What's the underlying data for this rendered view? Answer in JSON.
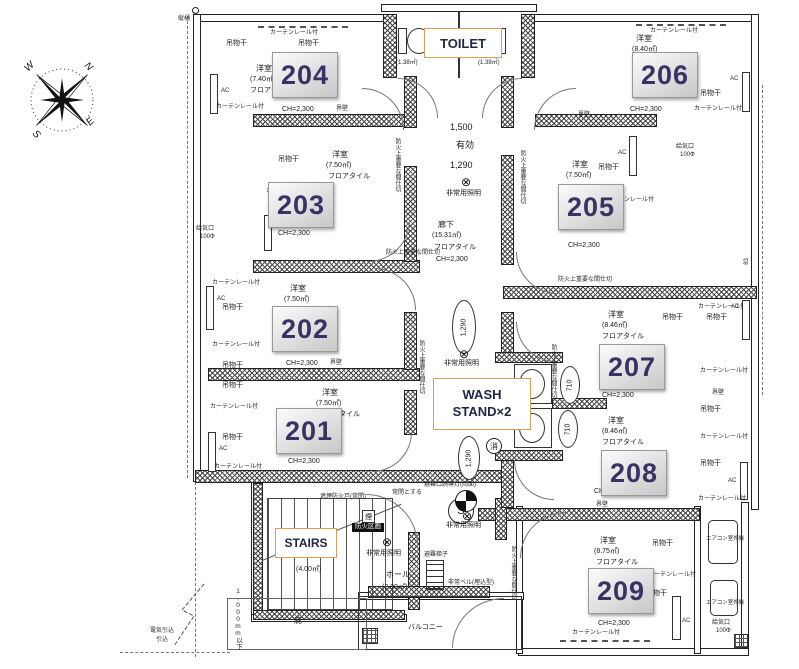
{
  "compass": {
    "n": "N",
    "e": "E",
    "s": "S",
    "w": "W"
  },
  "boxes": {
    "toilet": "TOILET",
    "wash_line1": "WASH",
    "wash_line2": "STAND×2",
    "stairs": "STAIRS"
  },
  "rooms": [
    {
      "number": "201",
      "type": "洋室",
      "area": "(7.50㎡)",
      "finish": "フロアタイル",
      "ch": "CH=2,300"
    },
    {
      "number": "202",
      "type": "洋室",
      "area": "(7.50㎡)",
      "finish": "フロアタイル",
      "ch": "CH=2,300"
    },
    {
      "number": "203",
      "type": "洋室",
      "area": "(7.50㎡)",
      "finish": "フロアタイル",
      "ch": "CH=2,300"
    },
    {
      "number": "204",
      "type": "洋室",
      "area": "(7.40㎡)",
      "finish": "フロアタイル",
      "ch": "CH=2,300"
    },
    {
      "number": "205",
      "type": "洋室",
      "area": "(7.50㎡)",
      "finish": "",
      "ch": "CH=2,300"
    },
    {
      "number": "206",
      "type": "洋室",
      "area": "(8.40㎡)",
      "finish": "",
      "ch": "CH=2,300"
    },
    {
      "number": "207",
      "type": "洋室",
      "area": "(8.46㎡)",
      "finish": "フロアタイル",
      "ch": "CH=2,300"
    },
    {
      "number": "208",
      "type": "洋室",
      "area": "(8.46㎡)",
      "finish": "フロアタイル",
      "ch": "CH=2,300"
    },
    {
      "number": "209",
      "type": "洋室",
      "area": "(8.75㎡)",
      "finish": "フロアタイル",
      "ch": "CH=2,300"
    }
  ],
  "corridor": {
    "name": "廊下",
    "area": "(15.31㎡)",
    "finish": "フロアタイル",
    "ch": "CH=2,300"
  },
  "hall": {
    "name": "ホール",
    "area": "(2.00㎡)"
  },
  "stairs": {
    "area": "(4.00㎡)"
  },
  "toilet": {
    "area_left": "(1.38㎡)",
    "area_right": "(1.38㎡)"
  },
  "dims": {
    "d1500": "1,500",
    "eff": "有効",
    "d1290": "1,290",
    "d710": "710",
    "d83": "83",
    "h1000": "1,000mm以下"
  },
  "labels": {
    "hanging": "吊物干",
    "maru": "○",
    "curtain_rail": "カーテンレール付",
    "ac": "AC",
    "kaihe": "界壁",
    "fire_partition": "防火上重要な間仕切",
    "supply": "給気口",
    "supply_d": "100Φ",
    "em_light": "非常用照明",
    "em_light_sym": "⊗",
    "exit_light": "避難口誘導灯(両面)",
    "ladder": "避難梯子",
    "em_bell": "非常ベル(埋込型)",
    "smoke_door": "遮煙防火戸(常閉)",
    "keep_closed": "常閉とする",
    "fire_block": "防火区画",
    "smoke": "煙",
    "s_mark": "S",
    "extinguisher": "消",
    "outdoor_unit": "エアコン室外機",
    "vertical_drain": "縦樋",
    "elec_lead": "電気引込",
    "lead_in": "引込",
    "canopy": "庇",
    "balcony": "バルコニー"
  }
}
